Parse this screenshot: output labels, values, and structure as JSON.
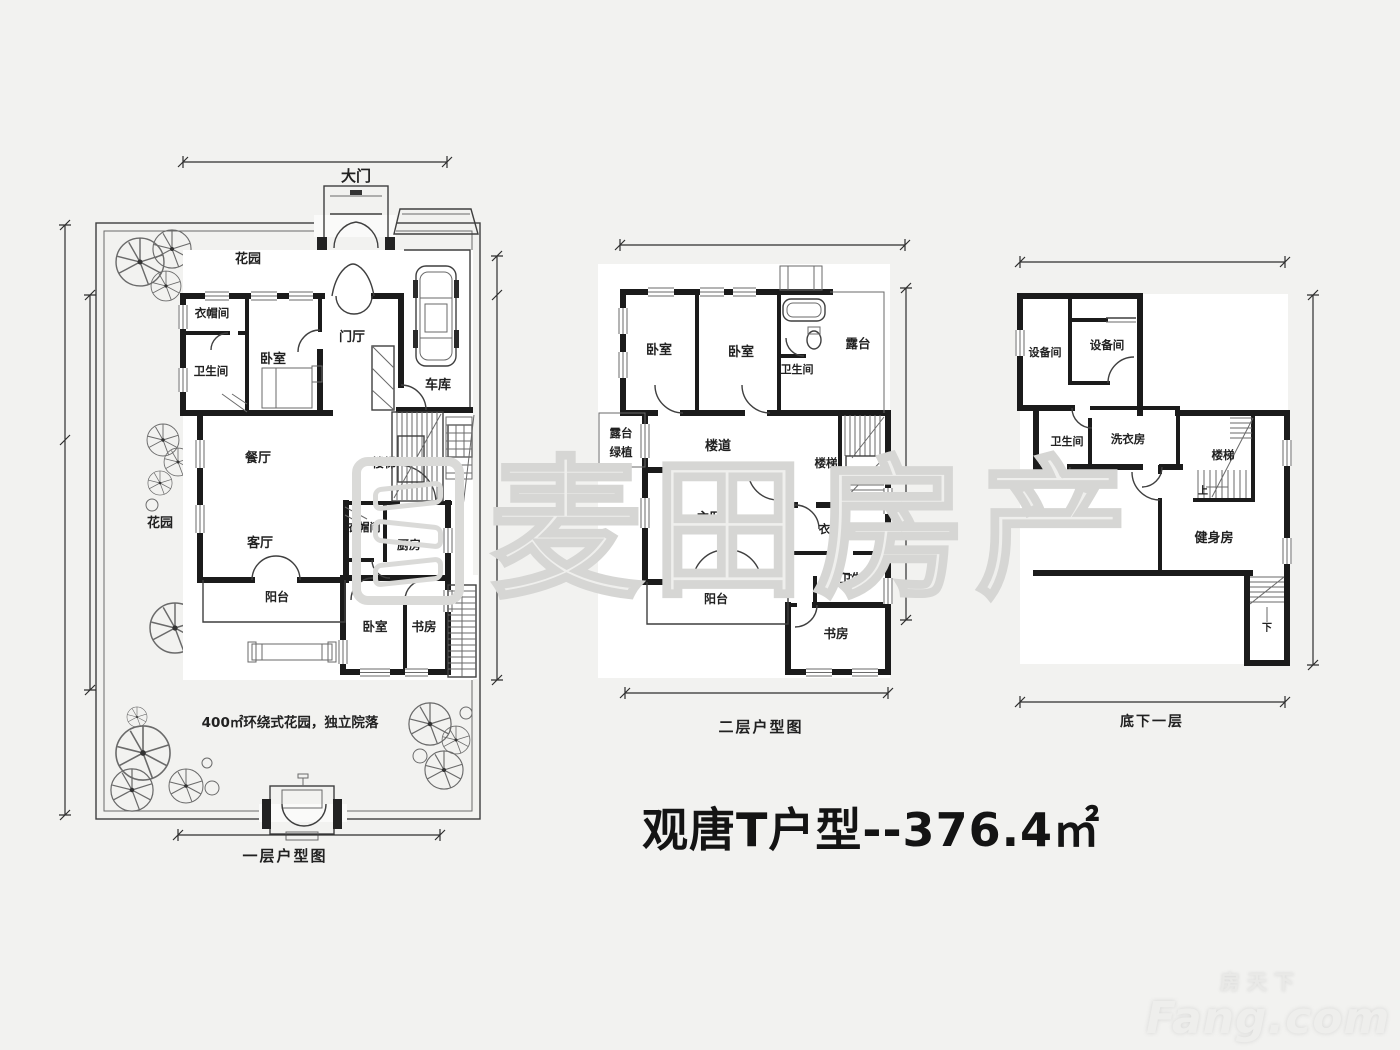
{
  "title": "观唐T户型--376.4㎡",
  "watermark_text": "麦田房产",
  "brand": {
    "cn": "房天下",
    "en": "Fang.com"
  },
  "colors": {
    "wall": "#1b1b1b",
    "thin_line": "#3f3f3f",
    "background": "#f2f2f0",
    "paper": "#ffffff",
    "watermark": "#d6d6d4"
  },
  "plans": [
    {
      "caption": "一层户型图",
      "gate_label": "大门",
      "note": "400㎡环绕式花园，独立院落",
      "rooms": {
        "garden_top": "花园",
        "garden_left": "花园",
        "cloakroom_top": "衣帽间",
        "bathroom": "卫生间",
        "bedroom_top": "卧室",
        "foyer": "门厅",
        "garage": "车库",
        "dining": "餐厅",
        "stairs": "楼梯",
        "living": "客厅",
        "cloakroom_mid": "衣帽间",
        "kitchen": "厨房",
        "balcony": "阳台",
        "bedroom_bottom": "卧室",
        "study": "书房"
      }
    },
    {
      "caption": "二层户型图",
      "rooms": {
        "bedroom_left": "卧室",
        "bedroom_mid": "卧室",
        "bathroom_top": "卫生间",
        "terrace": "露台",
        "terrace_green_1": "露台",
        "terrace_green_2": "绿植",
        "corridor": "楼道",
        "stairs": "楼梯",
        "master_bedroom": "主卧室",
        "cloakroom": "衣帽间",
        "bathroom_mid": "卫生间",
        "balcony": "阳台",
        "study": "书房"
      }
    },
    {
      "caption": "底下一层",
      "rooms": {
        "equipment_left": "设备间",
        "equipment_right": "设备间",
        "bathroom": "卫生间",
        "laundry": "洗衣房",
        "stairs": "楼梯",
        "up": "上",
        "cinema": "影音室",
        "gym": "健身房",
        "down": "下"
      }
    }
  ]
}
